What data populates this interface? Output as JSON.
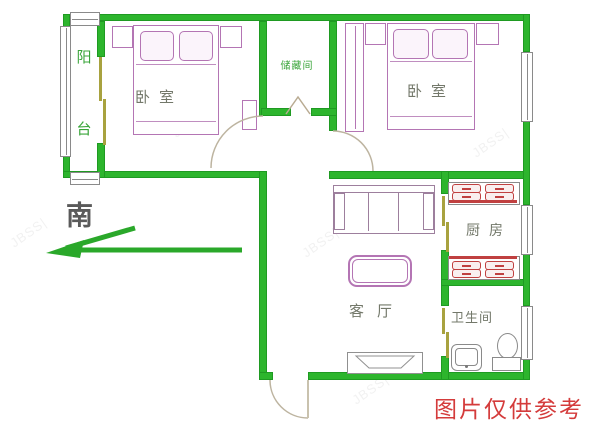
{
  "rooms": {
    "balcony": {
      "label": "阳台",
      "char_top": "阳",
      "char_bottom": "台"
    },
    "bedroom_left": {
      "label": "卧室"
    },
    "storage": {
      "label": "储藏间"
    },
    "bedroom_right": {
      "label": "卧室"
    },
    "living_room": {
      "label": "客厅"
    },
    "kitchen": {
      "label": "厨房"
    },
    "bathroom": {
      "label": "卫生间"
    }
  },
  "compass": {
    "south_label": "南"
  },
  "disclaimer": {
    "text": "图片仅供参考",
    "color": "#d43b3b"
  },
  "watermark": {
    "text": "JBSS|",
    "color": "#9a9a9a"
  },
  "colors": {
    "wall_green": "#2db52d",
    "furniture_pink": "#b475b4",
    "sofa_gray": "#9d7f9d",
    "counter_red": "#c04040",
    "fixture_gray": "#8a8a8a",
    "door_arc_tan": "#bdb4a0",
    "sliding_door_olive": "#a8a23f",
    "label_gray": "#73786a",
    "label_green": "#3aa53a",
    "compass_dark": "#5a5a5a",
    "arrow_green": "#2aa82a",
    "disclaimer_red": "#d43b3b",
    "watermark_gray": "#9a9a9a"
  }
}
